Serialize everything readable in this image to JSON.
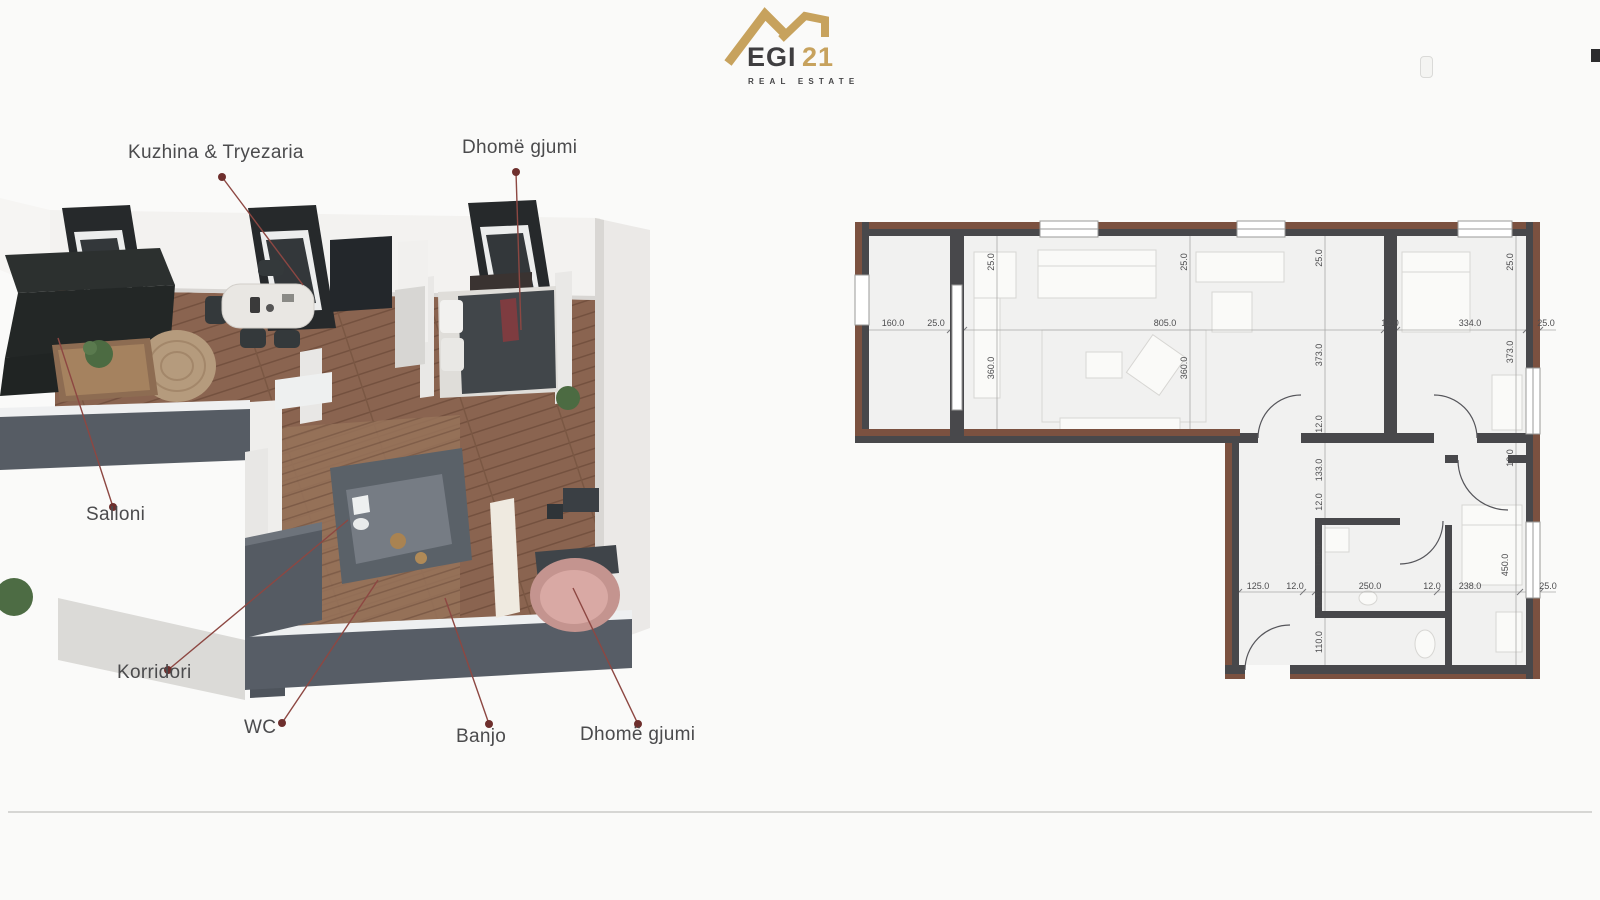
{
  "logo": {
    "name": "EGI",
    "suffix": "21",
    "tagline": "REAL ESTATE"
  },
  "labels": {
    "kitchen_dining": "Kuzhina & Tryezaria",
    "bedroom_top": "Dhomë gjumi",
    "living": "Salloni",
    "corridor": "Korridori",
    "wc": "WC",
    "bathroom": "Banjo",
    "bedroom_bottom": "Dhomë gjumi"
  },
  "plan2d": {
    "dims": {
      "t1": "160.0",
      "t2": "25.0",
      "t3": "805.0",
      "t4": "12.0",
      "t5": "334.0",
      "t6": "25.0",
      "v1": "25.0",
      "v2": "360.0",
      "v3": "25.0",
      "v4": "360.0",
      "v5": "25.0",
      "v6": "373.0",
      "v7": "12.0",
      "v8": "133.0",
      "v9": "12.0",
      "v10": "166.0",
      "v11": "12.0",
      "v12": "110.0",
      "v13": "25.0",
      "v14": "373.0",
      "v15": "12.0",
      "v16": "450.0",
      "b1": "125.0",
      "b2": "12.0",
      "b3": "250.0",
      "b4": "12.0",
      "b5": "238.0",
      "b6": "25.0"
    }
  },
  "colors": {
    "accent_gold": "#c7a25d",
    "leader_line": "#8d4742",
    "wall_dark": "#48484b",
    "wall_brown": "#7b5140",
    "wood_floor": "#8a6450"
  }
}
